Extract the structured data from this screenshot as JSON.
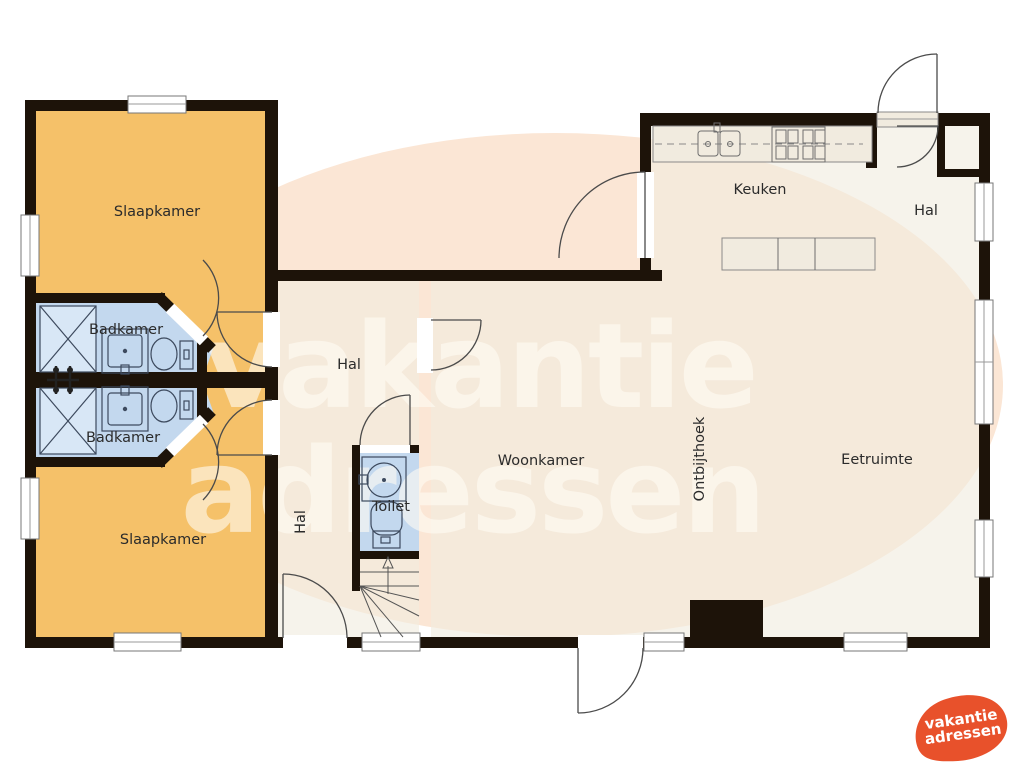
{
  "plan_title": "Vakantiehuis plattegrond (begane grond)",
  "rooms": {
    "slaapkamer_top": {
      "label": "Slaapkamer"
    },
    "badkamer_top": {
      "label": "Badkamer"
    },
    "badkamer_bottom": {
      "label": "Badkamer"
    },
    "slaapkamer_bottom": {
      "label": "Slaapkamer"
    },
    "hal_center": {
      "label": "Hal"
    },
    "hal_center_vertical": {
      "label": "Hal"
    },
    "toilet": {
      "label": "Toilet"
    },
    "keuken": {
      "label": "Keuken"
    },
    "hal_entrance": {
      "label": "Hal"
    },
    "woonkamer": {
      "label": "Woonkamer"
    },
    "ontbijthoek": {
      "label": "Ontbijthoek"
    },
    "eetruimte": {
      "label": "Eetruimte"
    }
  },
  "watermark": {
    "line1": "vakantie",
    "line2": "adressen"
  },
  "logo": {
    "line1": "vakantie",
    "line2": "adressen"
  },
  "colors": {
    "wall": "#1d1309",
    "bedroom": "#f5c169",
    "bathroom": "#c3d8ee",
    "shower": "#d8e7f6",
    "living": "#f1ebdf",
    "blob": "#fbe6d5",
    "logo": "#e8512b"
  }
}
